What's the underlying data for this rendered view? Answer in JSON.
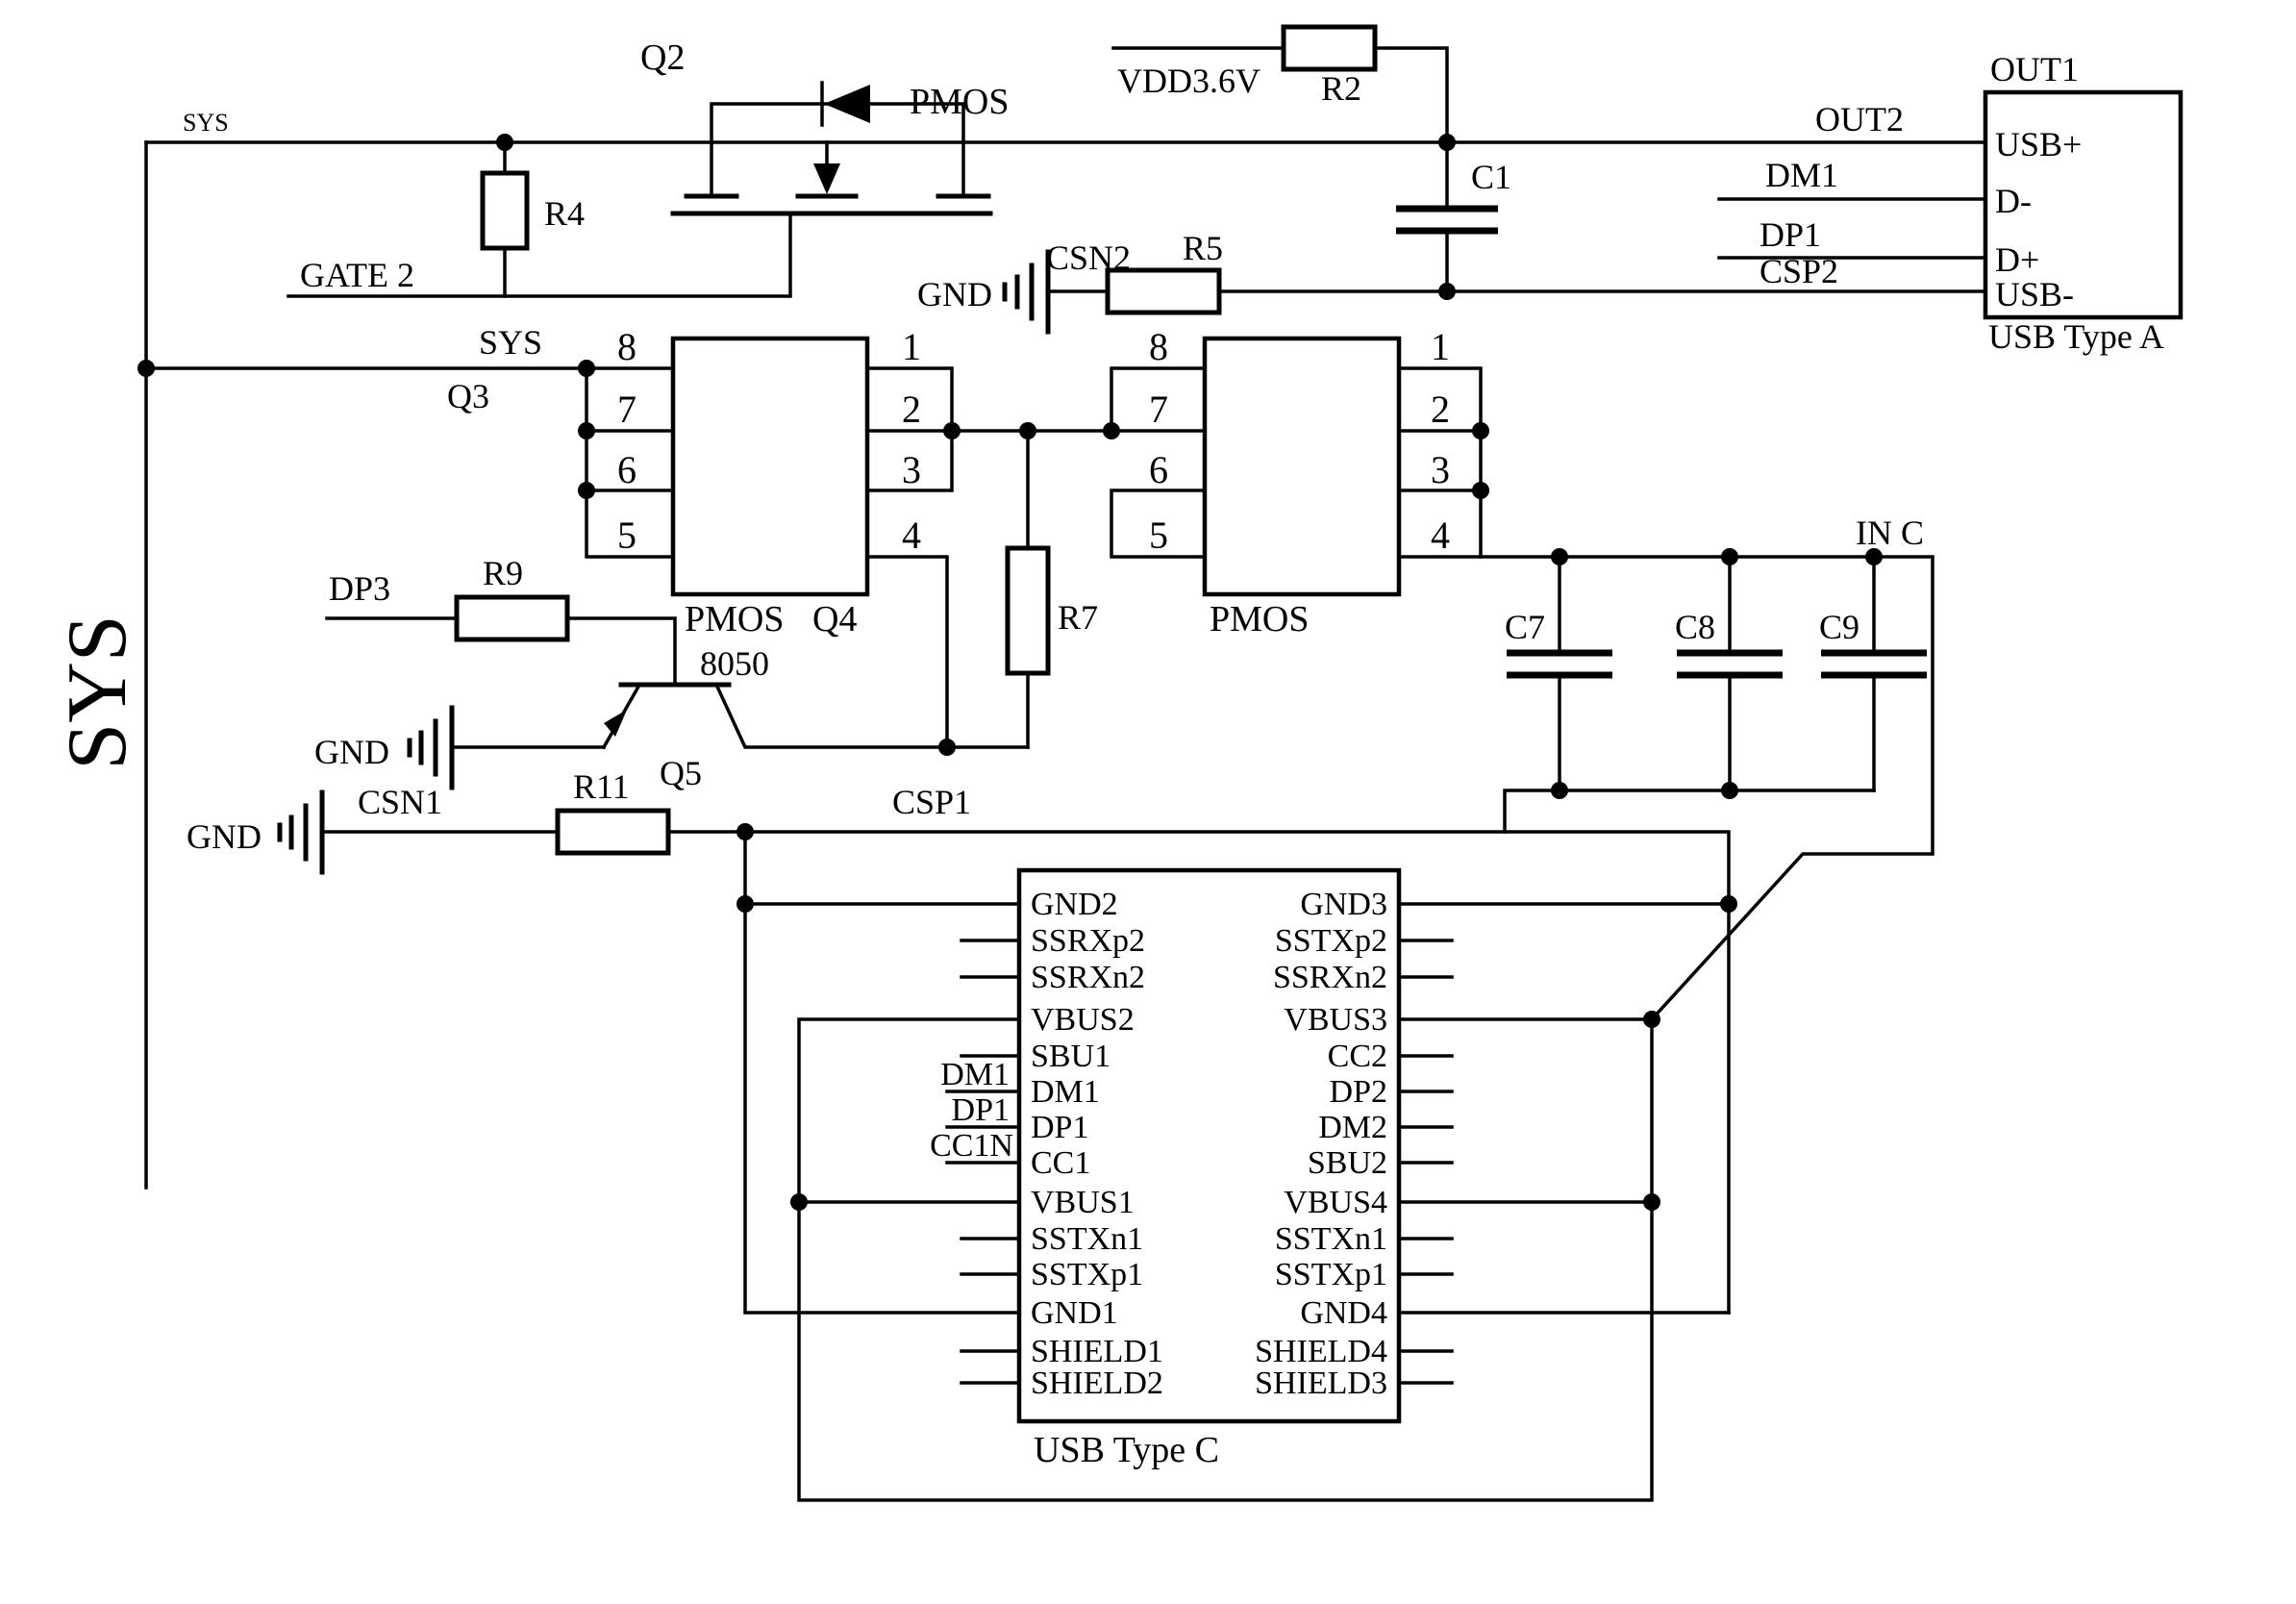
{
  "nets": {
    "sys_top": "SYS",
    "sys_mid": "SYS",
    "sys_big": "SYS",
    "gate2": "GATE 2",
    "vdd": "VDD3.6V",
    "csn2": "CSN2",
    "csp2": "CSP2",
    "out2": "OUT2",
    "dm1": "DM1",
    "dp1": "DP1",
    "dp3": "DP3",
    "csn1": "CSN1",
    "csp1": "CSP1",
    "in_c": "IN C",
    "gnd": "GND"
  },
  "components": {
    "q2": "Q2",
    "q2_type": "PMOS",
    "q3": "Q3",
    "q4": "Q4",
    "q5": "Q5",
    "q5_type": "8050",
    "r2": "R2",
    "r4": "R4",
    "r5": "R5",
    "r7": "R7",
    "r9": "R9",
    "r11": "R11",
    "c1": "C1",
    "c7": "C7",
    "c8": "C8",
    "c9": "C9",
    "ic1_type": "PMOS",
    "ic2_type": "PMOS"
  },
  "ic_pins": {
    "left": [
      "8",
      "7",
      "6",
      "5"
    ],
    "right": [
      "1",
      "2",
      "3",
      "4"
    ]
  },
  "usb_type_a": {
    "title": "OUT1",
    "pins": [
      "USB+",
      "D-",
      "D+",
      "USB-"
    ],
    "caption": "USB Type A"
  },
  "usb_type_c": {
    "caption": "USB Type C",
    "left": [
      "GND2",
      "SSRXp2",
      "SSRXn2",
      "VBUS2",
      "SBU1",
      "DM1",
      "DP1",
      "CC1",
      "VBUS1",
      "SSTXn1",
      "SSTXp1",
      "GND1",
      "SHIELD1",
      "SHIELD2"
    ],
    "right": [
      "GND3",
      "SSTXp2",
      "SSRXn2",
      "VBUS3",
      "CC2",
      "DP2",
      "DM2",
      "SBU2",
      "VBUS4",
      "SSTXn1",
      "SSTXp1",
      "GND4",
      "SHIELD4",
      "SHIELD3"
    ],
    "ext": [
      "DM1",
      "DP1",
      "CC1N"
    ]
  }
}
